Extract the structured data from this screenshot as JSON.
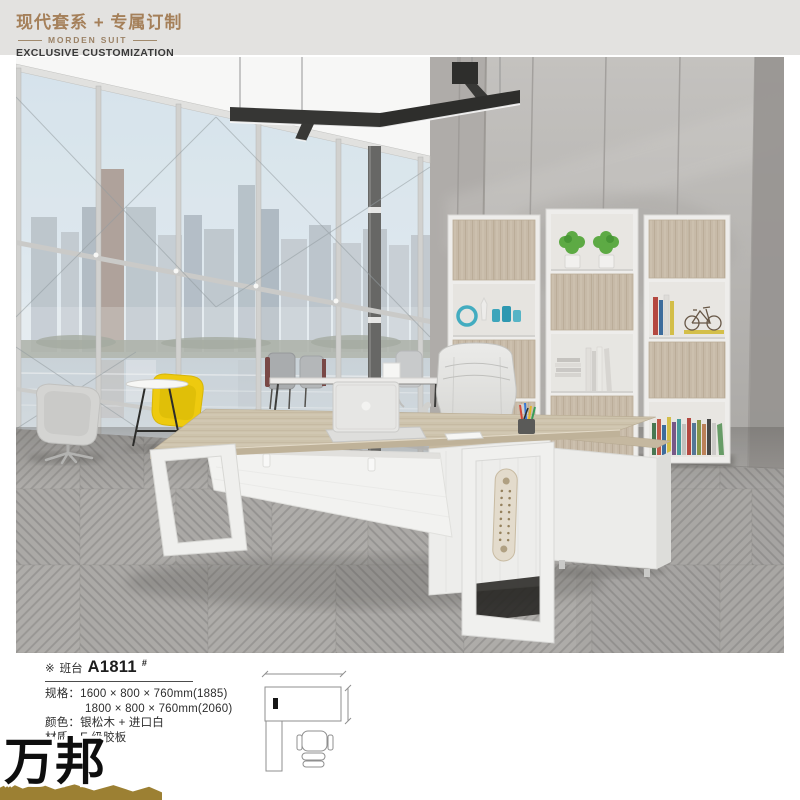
{
  "header": {
    "title_cn": "现代套系 + 专属订制",
    "series_en": "MORDEN SUIT",
    "tagline_en": "EXCLUSIVE CUSTOMIZATION"
  },
  "product": {
    "marker": "※",
    "category": "班台",
    "model": "A1811",
    "model_suffix": "#",
    "spec_lines": [
      "规格：1600 × 800 × 760mm(1885)",
      "1800 × 800 × 760mm(2060)",
      "颜色：银松木 + 进口白",
      "材质：E 级胶板"
    ]
  },
  "brand": {
    "name": "万邦"
  },
  "colors": {
    "header_bar_bg": "#e3e2e0",
    "logo_accent": "#a5805a",
    "tagline_text": "#3a3a3a",
    "ribbon_gold": "#9c8033",
    "desk_wood": "#d0c5ae",
    "cabinet_wood": "#cbbeac",
    "lounge_chair_yellow": "#f3cf10",
    "carpet_gray": "#b2b0ad",
    "concrete_wall_gray": "#bcbab7"
  }
}
